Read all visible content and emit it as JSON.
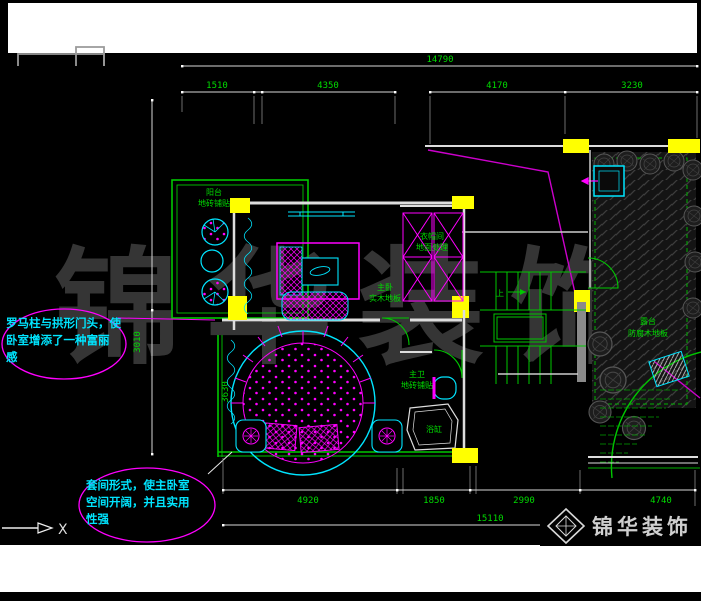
{
  "watermark": {
    "text": "锦华装饰"
  },
  "logo": {
    "brand": "锦华装饰"
  },
  "axis_label": "X",
  "callout_roman": {
    "line1": "罗马柱与拱形门头，使",
    "line2": "卧室增添了一种富丽",
    "line3": "感"
  },
  "callout_suite": {
    "line1": "套间形式，使主卧室",
    "line2": "空间开阔，并且实用",
    "line3": "性强"
  },
  "dims": {
    "top_overall": "14790",
    "top_1": "1510",
    "top_2": "4350",
    "top_3": "4170",
    "top_4": "3230",
    "bottom_overall": "15110",
    "bottom_1": "4920",
    "bottom_2": "1850",
    "bottom_3": "2990",
    "bottom_4": "4740",
    "left_1": "3010",
    "interior_1": "3630"
  },
  "rooms": {
    "balcony_name": "阳台",
    "balcony_finish": "地砖铺贴",
    "bedroom_name": "主卧",
    "bedroom_finish": "实木地板",
    "closet_name": "衣帽间",
    "closet_finish": "地面处理",
    "bath_name": "主卫",
    "bath_finish": "地砖铺贴",
    "terrace_name": "露台",
    "terrace_finish": "防腐木地板",
    "tub_label": "浴缸",
    "stair_up": "上"
  },
  "colors": {
    "line_green": "#00c800",
    "text_green": "#00dc00",
    "cyan": "#00e5ff",
    "magenta": "#ff00ff",
    "yellow": "#ffff00",
    "wall_white": "#e0e0e0",
    "watermark_gray": "#383838"
  }
}
